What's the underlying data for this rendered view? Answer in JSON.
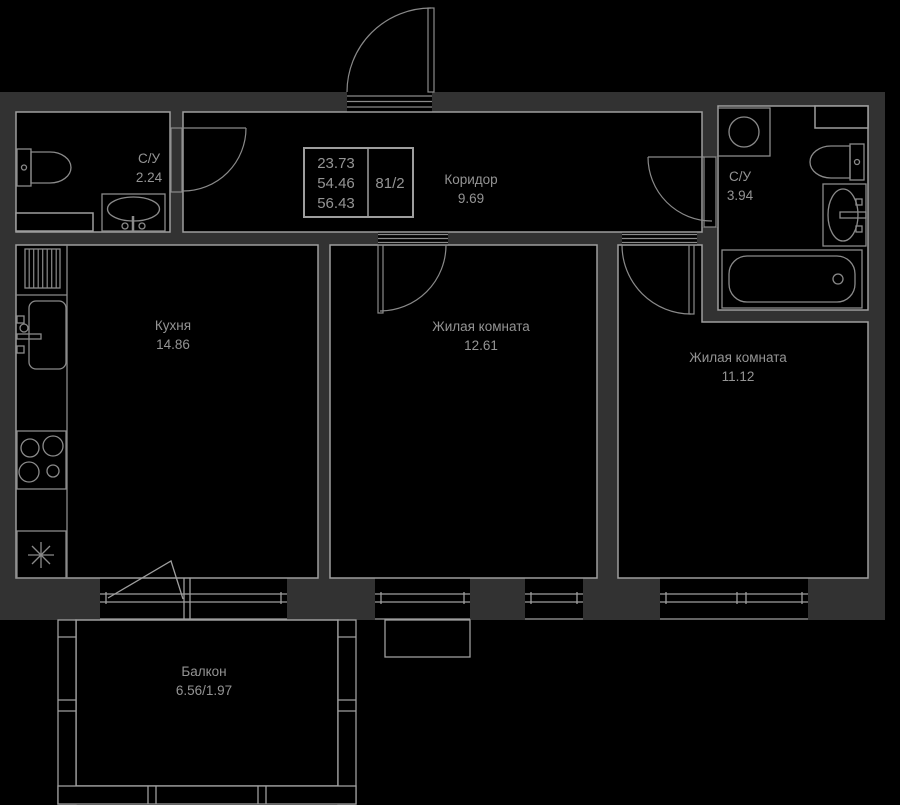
{
  "plan": {
    "stamp": {
      "values": [
        "23.73",
        "54.46",
        "56.43"
      ],
      "number": "81/2"
    },
    "rooms": [
      {
        "name": "С/У",
        "area": "2.24"
      },
      {
        "name": "Коридор",
        "area": "9.69"
      },
      {
        "name": "С/У",
        "area": "3.94"
      },
      {
        "name": "Кухня",
        "area": "14.86"
      },
      {
        "name": "Жилая комната",
        "area": "12.61"
      },
      {
        "name": "Жилая комната",
        "area": "11.12"
      },
      {
        "name": "Балкон",
        "area": "6.56/1.97"
      }
    ],
    "colors": {
      "background": "#000000",
      "wall": "#323232",
      "line": "#9e9e9e",
      "fixture": "#8a8a8a",
      "text": "#949494"
    }
  }
}
